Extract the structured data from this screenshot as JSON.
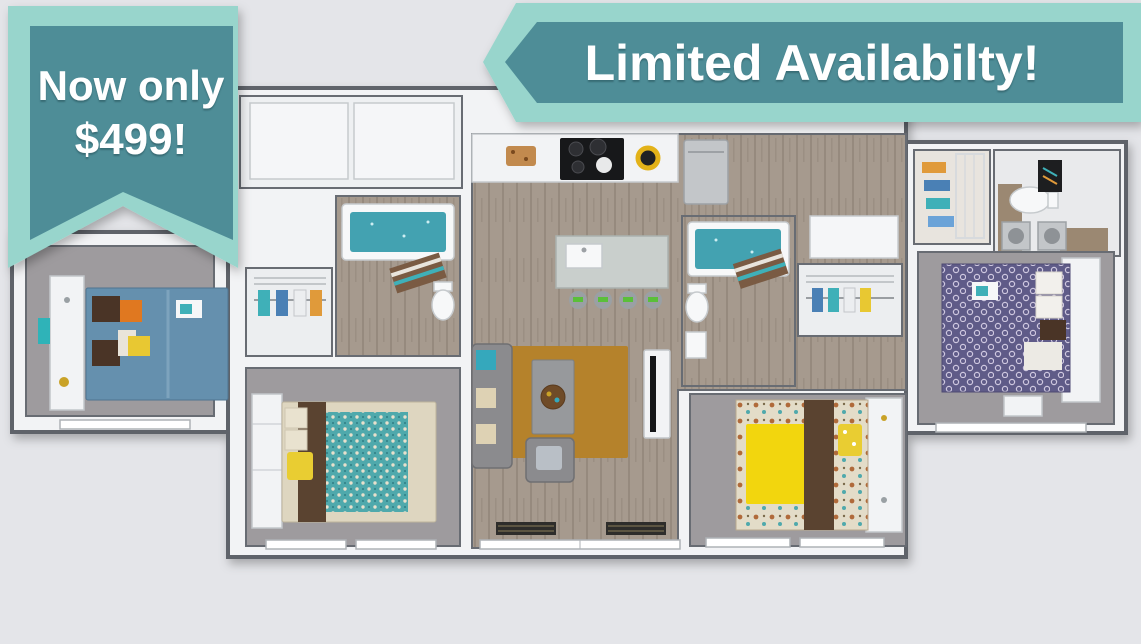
{
  "banners": {
    "price": {
      "line1": "Now only",
      "line2": "$499!"
    },
    "availability": {
      "label": "Limited Availabilty!"
    }
  },
  "colors": {
    "background": "#e4e5e9",
    "banner_outer": "#98d5cc",
    "banner_inner": "#4e8d97",
    "banner_text": "#ffffff",
    "wood": "#a69a8e",
    "carpet": "#9e9b9e",
    "wall_white": "#f2f3f5",
    "wall_edge": "#5f646b",
    "tub_teal": "#43a2b1",
    "rug_gold": "#b5822b",
    "bed_blue": "#6590ae",
    "bed_teal": "#4fa9ac",
    "bed_purple": "#5f5b88",
    "bed_yellow": "#f2d60e",
    "throw_brown": "#5a4330",
    "pillow_orange": "#e07820",
    "pillow_yellow": "#e9cd32",
    "stool_green": "#5abf3a"
  }
}
